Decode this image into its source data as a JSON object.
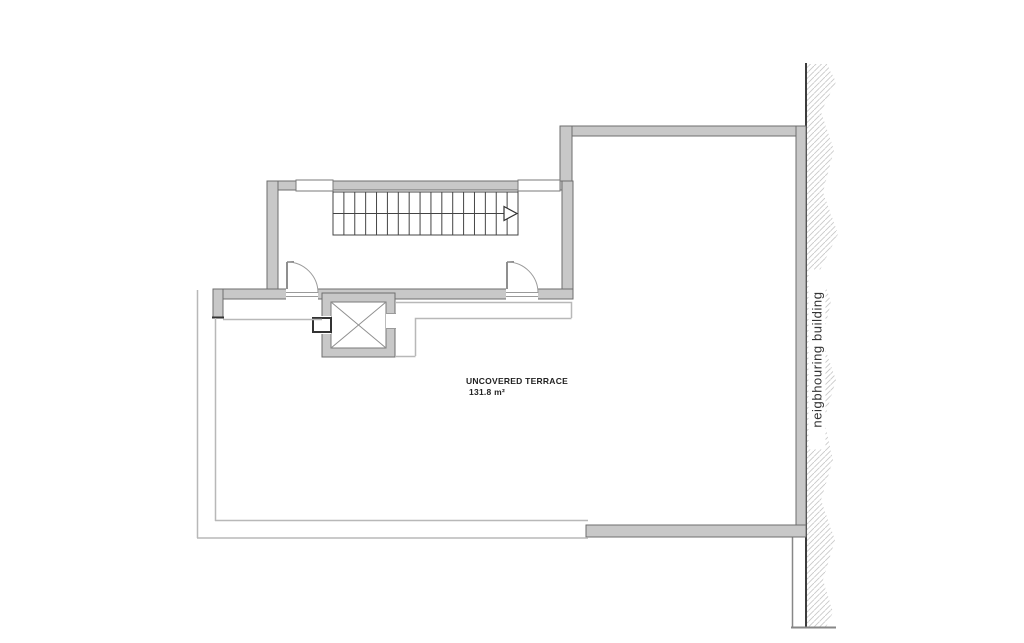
{
  "labels": {
    "terrace_name": "UNCOVERED TERRACE",
    "terrace_area": "131.8 m²",
    "neighbouring_building": "neigbhouring building"
  },
  "colors": {
    "wall_fill": "#c8c8c8",
    "wall_edge": "#6e6e6e",
    "thin_line": "#b8b8b8",
    "stair_line": "#444444",
    "hatch_line": "#c9c9c9",
    "boundary_line": "#3d3d3d",
    "text": "#222222",
    "background": "#ffffff"
  },
  "stairs": {
    "treads": 17,
    "direction_arrow": "right"
  },
  "elevator": {
    "symbol": "x-cross"
  }
}
